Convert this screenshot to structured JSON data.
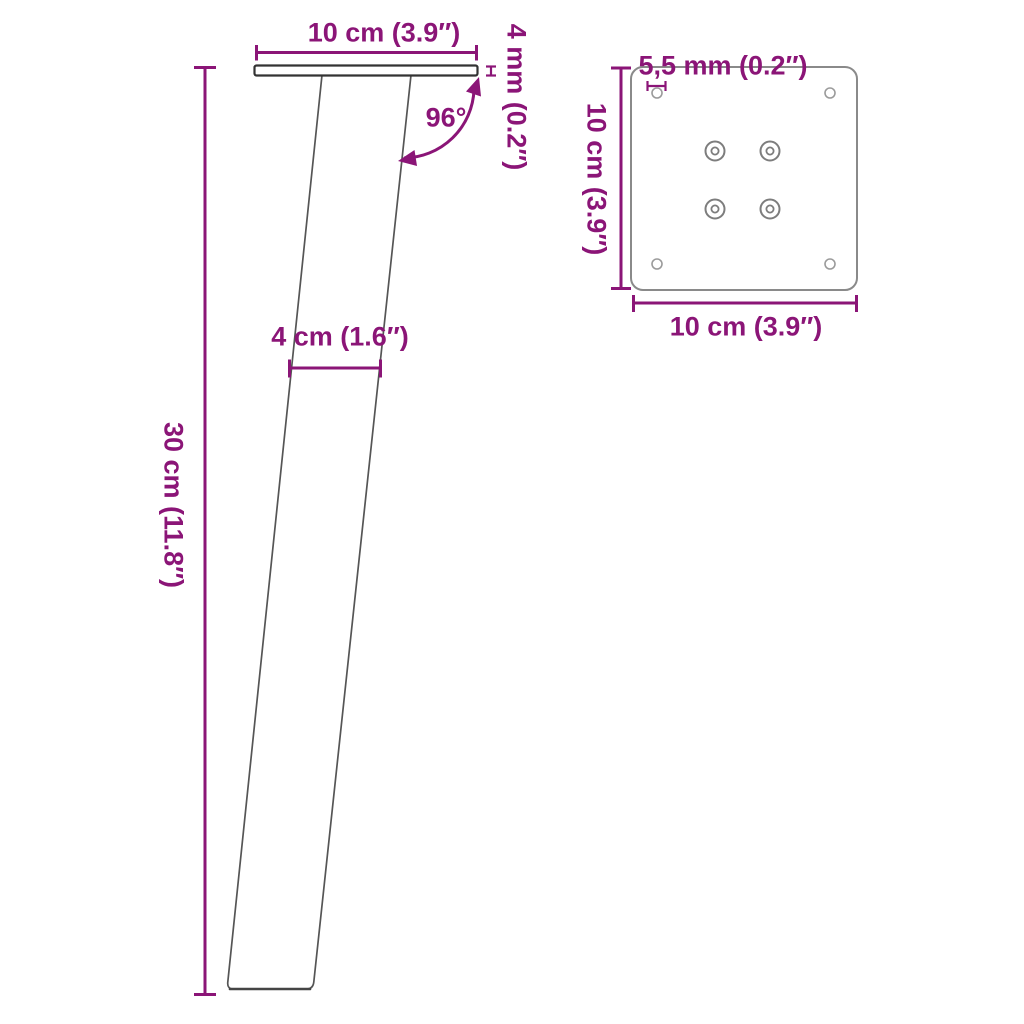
{
  "colors": {
    "bg": "#ffffff",
    "accent": "#8B1577",
    "plate_side_stroke": "#333333",
    "leg_stroke": "#555555",
    "leg_bottom_stroke": "#454545",
    "plate_top_stroke": "#8a8a8a",
    "corner_hole_stroke": "#9b9b9b",
    "screw_hole_stroke": "#7d7d7d"
  },
  "side_view": {
    "top_width_label": "10 cm (3.9″)",
    "plate_thickness_label": "4 mm (0.2″)",
    "angle_label": "96°",
    "leg_width_label": "4 cm (1.6″)",
    "height_label": "30 cm (11.8″)"
  },
  "top_view": {
    "hole_diameter_label": "5,5 mm (0.2″)",
    "height_label": "10 cm (3.9″)",
    "width_label": "10 cm (3.9″)"
  }
}
